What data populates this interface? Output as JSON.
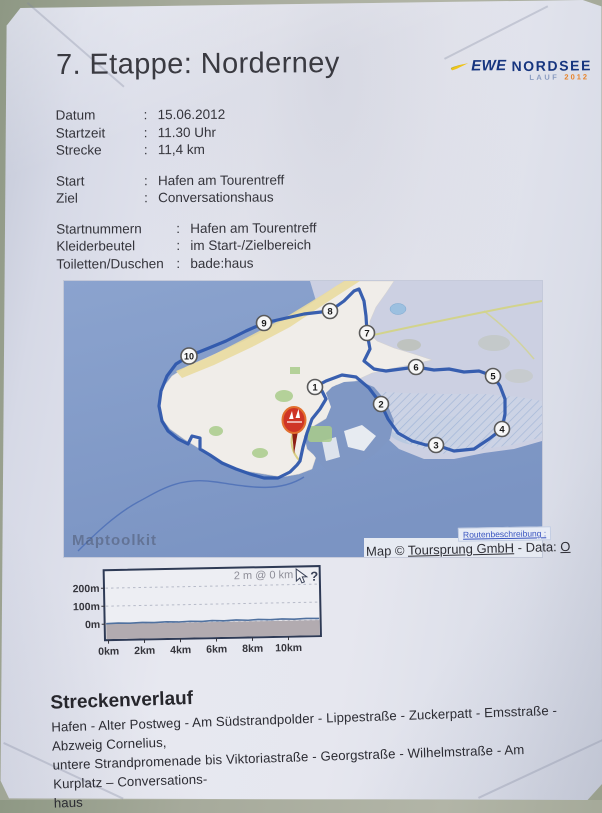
{
  "document": {
    "title": "7. Etappe: Norderney",
    "logo": {
      "brand": "EWE",
      "name": "NORDSEE",
      "sub_left": "LAUF",
      "sub_right": "2012"
    },
    "info": {
      "group1": [
        {
          "label": "Datum",
          "sep": ":",
          "value": "15.06.2012"
        },
        {
          "label": "Startzeit",
          "sep": ":",
          "value": "11.30 Uhr"
        },
        {
          "label": "Strecke",
          "sep": ":",
          "value": "11,4 km"
        }
      ],
      "group2": [
        {
          "label": "Start",
          "sep": ":",
          "value": "Hafen am Tourentreff"
        },
        {
          "label": "Ziel",
          "sep": ":",
          "value": "Conversationshaus"
        }
      ],
      "group3": [
        {
          "label": "Startnummern",
          "sep": ":",
          "value": "Hafen am Tourentreff"
        },
        {
          "label": "Kleiderbeutel",
          "sep": ":",
          "value": "im Start-/Zielbereich"
        },
        {
          "label": "Toiletten/Duschen",
          "sep": ":",
          "value": "bade:haus"
        }
      ]
    },
    "map": {
      "watermark": "Maptoolkit",
      "route_link_label": "Routenbeschreibung :",
      "attribution": {
        "prefix": "Map © ",
        "link": "Toursprung GmbH",
        "middle": " - Data: ",
        "suffix": "O"
      },
      "markers": [
        {
          "n": "1"
        },
        {
          "n": "2"
        },
        {
          "n": "3"
        },
        {
          "n": "4"
        },
        {
          "n": "5"
        },
        {
          "n": "6"
        },
        {
          "n": "7"
        },
        {
          "n": "8"
        },
        {
          "n": "9"
        },
        {
          "n": "10"
        }
      ],
      "colors": {
        "route": "#2e57ac",
        "water": "#7f97c4",
        "flats": "#ccd0e2",
        "land": "#f0ede9"
      }
    },
    "chart_data": {
      "type": "area",
      "title": "2 m @ 0 km",
      "x_tick_labels": [
        "0km",
        "2km",
        "4km",
        "6km",
        "8km",
        "10km"
      ],
      "y_tick_labels": [
        "200m",
        "100m",
        "0m"
      ],
      "xlim_km": [
        0,
        11.7
      ],
      "ylim_m": [
        0,
        250
      ],
      "distance_km": 11.4,
      "grid": "dashed-horizontal",
      "help_glyph": "?",
      "series": [
        {
          "name": "elevation",
          "x_km": [
            0,
            1,
            2,
            3,
            4,
            5,
            6,
            7,
            8,
            9,
            10,
            11,
            11.4
          ],
          "values_m": [
            2,
            2,
            2,
            3,
            2,
            2,
            3,
            2,
            3,
            2,
            3,
            2,
            2
          ]
        }
      ]
    },
    "strecke_section": {
      "heading": "Streckenverlauf",
      "lines": [
        "Hafen - Alter Postweg - Am Südstrandpolder - Lippestraße - Zuckerpatt - Emsstraße - Abzweig Cornelius,",
        "untere Strandpromenade bis Viktoriastraße - Georgstraße - Wilhelmstraße - Am Kurplatz – Conversations-",
        "haus"
      ]
    }
  }
}
